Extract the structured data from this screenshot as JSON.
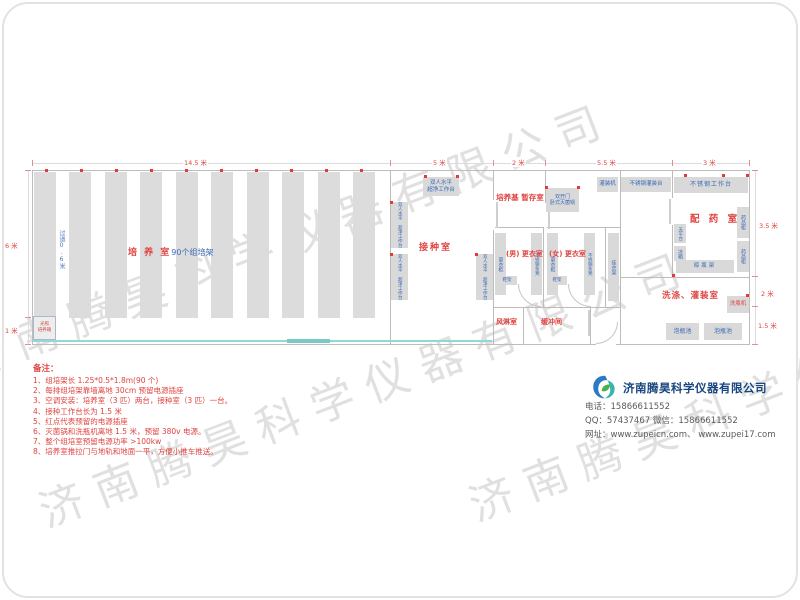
{
  "watermark": {
    "text": "济南腾昊科学仪器有限公司"
  },
  "dims": {
    "top": [
      "14.5 米",
      "5 米",
      "2 米",
      "5.5 米",
      "3 米"
    ],
    "left": [
      "6 米",
      "1 米"
    ],
    "right": [
      "3.5 米",
      "2 米",
      "1.5 米"
    ]
  },
  "culture_room": {
    "name": "培 养 室",
    "shelves": "90个组培架",
    "aisle": "过道0.6米",
    "incubator": "光照\n培养箱"
  },
  "inoculation_room": {
    "name": "接种室",
    "bench": "双人水平\n超净工作台"
  },
  "medium_storage": {
    "name": "培养基\n暂存室"
  },
  "sterilizer": "双开门\n卧式灭菌锅",
  "filling": {
    "machine": "灌装机",
    "table": "不锈钢灌装台"
  },
  "pharmacy": {
    "name": "配 药 室",
    "worktable": "不锈钢工作台",
    "cabinet": "药品柜",
    "balance": "天平台",
    "fridge": "冰箱",
    "bottle_rack": "晾瓶架"
  },
  "changing": {
    "men": "(男)\n更衣室",
    "women": "(女)\n更衣室",
    "wardrobe": "更衣柜",
    "bench": "不锈钢条凳",
    "coat_rack": "挂衣架",
    "shoe_rack": "鞋架"
  },
  "air_shower": "风淋室",
  "buffer_room": "缓冲间",
  "washing": {
    "name": "洗涤、灌装室",
    "washer": "洗瓶机",
    "pool": "泡瓶池"
  },
  "notes": {
    "title": "备注：",
    "items": [
      "1、组培架长 1.25*0.5*1.8m(90 个)",
      "2、每排组培架靠墙离地 30cm 预留电源插座",
      "3、空调安装：培养室（3 匹）两台，接种室（3 匹）一台。",
      "4、接种工作台长为 1.5 米",
      "5、红点代表预留的电源插座",
      "6、灭菌锅和洗瓶机离地 1.5 米，预留 380v 电源。",
      "7、整个组培室预留电源功率 >100kw",
      "8、培养室推拉门与地轨和地面一平，方便小推车推送。"
    ]
  },
  "company": {
    "name": "济南腾昊科学仪器有限公司",
    "phone": "电话：15866611552",
    "qq": "QQ：57437467  微信：15866611552",
    "web": "网址：www.zupeicn.com、 www.zupei17.com"
  }
}
